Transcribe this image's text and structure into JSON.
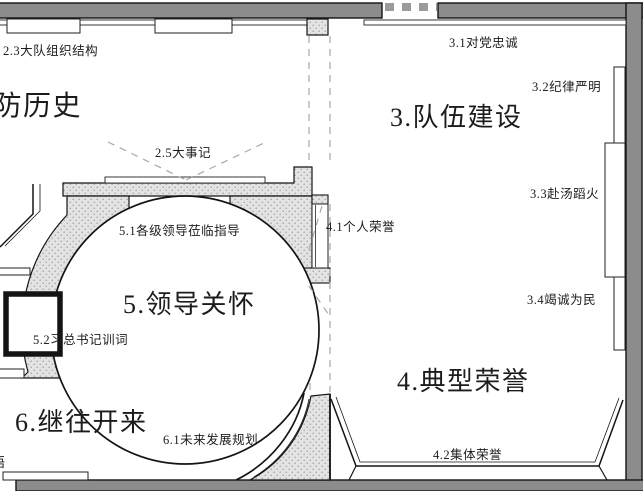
{
  "drawing_type": "exhibition-hall-floor-plan",
  "labels": {
    "l23": "2.3大队组织结构",
    "big_history": "消防历史",
    "l25": "2.5大事记",
    "l31": "3.1对党忠诚",
    "l32": "3.2纪律严明",
    "big3": "3.队伍建设",
    "l33": "3.3赴汤蹈火",
    "l41": "4.1个人荣誉",
    "l34": "3.4竭诚为民",
    "big4": "4.典型荣誉",
    "l42": "4.2集体荣誉",
    "l51": "5.1各级领导莅临指导",
    "big5": "5.领导关怀",
    "l52": "5.2习总书记训词",
    "big6": "6.继往开来",
    "l61": "6.1未来发展规划",
    "edge_partial": "语"
  },
  "colors": {
    "wall": "#8c8c8c",
    "hatch_background": "#e3e3e3",
    "hatch_dot": "#a3a3a3",
    "outline": "#141414",
    "dashed_guide": "#a8a8a8"
  }
}
